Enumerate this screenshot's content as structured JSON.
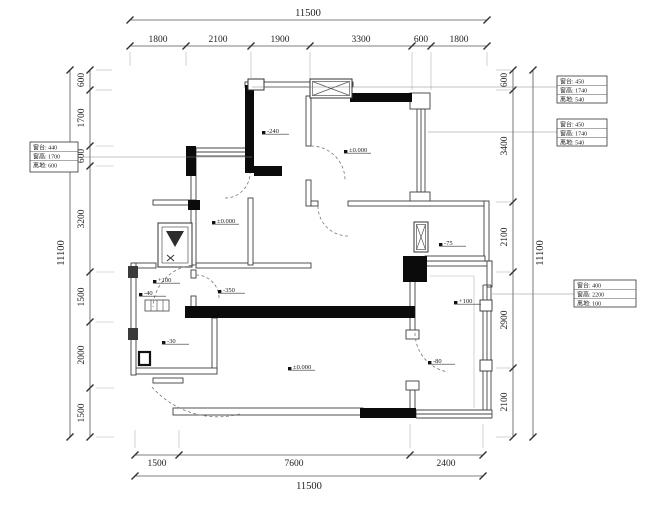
{
  "canvas": {
    "w": 648,
    "h": 505,
    "bg": "#ffffff",
    "wall_fill": "#0b0b0b",
    "thin_stroke": "#3f3f3f",
    "dim_color": "#555555",
    "text_color": "#222222",
    "leader_color": "#888888"
  },
  "dims": {
    "top_total": {
      "label": "11500",
      "x1": 130,
      "x2": 487,
      "y": 20,
      "tx": 308,
      "ty": 16
    },
    "top_segs": {
      "y": 46,
      "ticks": [
        130,
        186,
        251,
        310,
        412,
        431,
        487
      ],
      "labels": [
        {
          "t": "1800",
          "x": 158
        },
        {
          "t": "2100",
          "x": 218
        },
        {
          "t": "1900",
          "x": 280
        },
        {
          "t": "3300",
          "x": 361
        },
        {
          "t": "600",
          "x": 421
        },
        {
          "t": "1800",
          "x": 459
        }
      ],
      "ty": 42
    },
    "bottom_segs": {
      "y": 455,
      "ticks": [
        135,
        179,
        410,
        483
      ],
      "labels": [
        {
          "t": "1500",
          "x": 157
        },
        {
          "t": "7600",
          "x": 294
        },
        {
          "t": "2400",
          "x": 446
        }
      ],
      "ty": 466
    },
    "bottom_total": {
      "label": "11500",
      "x1": 135,
      "x2": 483,
      "y": 476,
      "tx": 309,
      "ty": 489
    },
    "left_segs": {
      "x": 90,
      "ticks": [
        70,
        90,
        146,
        166,
        272,
        322,
        388,
        437
      ],
      "labels": [
        {
          "t": "600",
          "y": 80
        },
        {
          "t": "1700",
          "y": 118
        },
        {
          "t": "600",
          "y": 156
        },
        {
          "t": "3200",
          "y": 219
        },
        {
          "t": "1500",
          "y": 297
        },
        {
          "t": "2000",
          "y": 355
        },
        {
          "t": "1500",
          "y": 413
        }
      ],
      "tx": 84
    },
    "left_total": {
      "label": "11100",
      "x": 70,
      "y1": 70,
      "y2": 437,
      "tx": 64,
      "ty": 253
    },
    "right_segs": {
      "x": 513,
      "ticks": [
        70,
        90,
        202,
        272,
        368,
        437
      ],
      "labels": [
        {
          "t": "600",
          "y": 80
        },
        {
          "t": "3400",
          "y": 146
        },
        {
          "t": "2100",
          "y": 237
        },
        {
          "t": "2900",
          "y": 320
        },
        {
          "t": "2100",
          "y": 402
        }
      ],
      "tx": 507
    },
    "right_total": {
      "label": "11100",
      "x": 533,
      "y1": 70,
      "y2": 437,
      "tx": 543,
      "ty": 253
    }
  },
  "markers": [
    {
      "t": "-240",
      "x": 270,
      "y": 130
    },
    {
      "t": "±0.000",
      "x": 352,
      "y": 149
    },
    {
      "t": "±0.000",
      "x": 220,
      "y": 220
    },
    {
      "t": "-350",
      "x": 226,
      "y": 289
    },
    {
      "t": "+100",
      "x": 161,
      "y": 279
    },
    {
      "t": "-40",
      "x": 147,
      "y": 292
    },
    {
      "t": "-30",
      "x": 170,
      "y": 340
    },
    {
      "t": "±0.000",
      "x": 296,
      "y": 366
    },
    {
      "t": "-75",
      "x": 447,
      "y": 242
    },
    {
      "t": "+100",
      "x": 462,
      "y": 300
    },
    {
      "t": "-80",
      "x": 436,
      "y": 360
    }
  ],
  "ann_boxes": [
    {
      "x": 30,
      "y": 142,
      "w": 48,
      "h": 30,
      "lines": [
        "窗台: 440",
        "窗高: 1700",
        "离地: 600"
      ],
      "leader": {
        "x1": 78,
        "y1": 157,
        "x2": 252,
        "y2": 157
      }
    },
    {
      "x": 557,
      "y": 76,
      "w": 50,
      "h": 27,
      "lines": [
        "窗台: 450",
        "窗高: 1740",
        "离地: 540"
      ],
      "leader": {
        "x1": 557,
        "y1": 87,
        "x2": 252,
        "y2": 87
      }
    },
    {
      "x": 557,
      "y": 119,
      "w": 50,
      "h": 27,
      "lines": [
        "窗台: 450",
        "窗高: 1740",
        "离地: 540"
      ],
      "leader": {
        "x1": 557,
        "y1": 132,
        "x2": 428,
        "y2": 132
      }
    },
    {
      "x": 574,
      "y": 280,
      "w": 62,
      "h": 27,
      "lines": [
        "窗台: 400",
        "窗高: 2200",
        "离地: 100"
      ],
      "leader": {
        "x1": 574,
        "y1": 294,
        "x2": 492,
        "y2": 294
      }
    }
  ],
  "walls_thin": [
    [
      245,
      82,
      108,
      5
    ],
    [
      311,
      93,
      41,
      5
    ],
    [
      410,
      93,
      20,
      16
    ],
    [
      410,
      192,
      20,
      14
    ],
    [
      306,
      96,
      5,
      50
    ],
    [
      306,
      180,
      5,
      26
    ],
    [
      311,
      201,
      7,
      5
    ],
    [
      348,
      201,
      137,
      5
    ],
    [
      484,
      201,
      5,
      64
    ],
    [
      191,
      157,
      5,
      108
    ],
    [
      133,
      263,
      23,
      5
    ],
    [
      196,
      263,
      115,
      5
    ],
    [
      248,
      198,
      5,
      67
    ],
    [
      153,
      200,
      43,
      5
    ],
    [
      191,
      270,
      5,
      8
    ],
    [
      191,
      296,
      5,
      15
    ],
    [
      212,
      318,
      5,
      52
    ],
    [
      133,
      368,
      84,
      6
    ],
    [
      153,
      378,
      30,
      5
    ],
    [
      131,
      263,
      5,
      112
    ],
    [
      173,
      408,
      190,
      7
    ],
    [
      416,
      261,
      76,
      5
    ],
    [
      487,
      261,
      5,
      26
    ],
    [
      425,
      256,
      60,
      5
    ],
    [
      410,
      280,
      5,
      52
    ],
    [
      410,
      390,
      5,
      20
    ],
    [
      406,
      330,
      13,
      9
    ],
    [
      406,
      381,
      13,
      9
    ]
  ],
  "walls_black": [
    [
      245,
      85,
      9,
      88
    ],
    [
      350,
      93,
      62,
      9
    ],
    [
      186,
      146,
      10,
      30
    ],
    [
      254,
      166,
      28,
      10
    ],
    [
      185,
      306,
      230,
      12
    ],
    [
      403,
      256,
      24,
      26
    ],
    [
      360,
      408,
      56,
      10
    ],
    [
      188,
      200,
      12,
      10
    ]
  ],
  "windows": [
    {
      "o": "h",
      "x1": 196,
      "x2": 248,
      "y": 148
    },
    {
      "o": "v",
      "x": 417,
      "y1": 109,
      "y2": 192
    },
    {
      "o": "v",
      "x": 483,
      "y1": 285,
      "y2": 410
    },
    {
      "o": "h",
      "x1": 416,
      "x2": 492,
      "y": 410
    }
  ],
  "hatch_boxes": [
    {
      "x": 310,
      "y": 79,
      "w": 42,
      "h": 19
    },
    {
      "x": 414,
      "y": 222,
      "w": 14,
      "h": 30
    }
  ],
  "shaft": {
    "x": 158,
    "y": 223,
    "w": 34,
    "h": 44,
    "tri": "166,231 184,231 175,247"
  },
  "window_box": {
    "x": 248,
    "y": 79,
    "w": 16,
    "h": 11
  },
  "small_box": {
    "x": 139,
    "y": 352,
    "w": 11,
    "h": 13
  },
  "steps": {
    "x": 145,
    "y": 300,
    "w": 24,
    "h": 11
  },
  "piers_dark": [
    [
      128,
      266,
      10,
      12
    ],
    [
      128,
      328,
      10,
      12
    ]
  ],
  "piers_light": [
    [
      480,
      300,
      12,
      11
    ],
    [
      480,
      360,
      12,
      11
    ]
  ],
  "arcs": [
    "M 197,265 A 44,44 0 0 0 153,307",
    "M 152,387 A 88,88 0 0 0 240,414",
    "M 415,333 A 40,40 0 0 0 448,372",
    "M 311,146 A 34,34 0 0 1 345,180",
    "M 225,198 A 25,25 0 0 0 250,173",
    "M 318,206 A 30,30 0 0 0 348,236",
    "M 196,275 A 23,23 0 0 1 219,298"
  ],
  "ext_lines": [
    [
      130,
      52,
      130,
      66
    ],
    [
      186,
      52,
      186,
      66
    ],
    [
      251,
      52,
      251,
      78
    ],
    [
      310,
      52,
      310,
      90
    ],
    [
      412,
      52,
      412,
      90
    ],
    [
      431,
      52,
      431,
      90
    ],
    [
      487,
      52,
      487,
      66
    ],
    [
      135,
      430,
      135,
      448
    ],
    [
      179,
      430,
      179,
      448
    ],
    [
      410,
      424,
      410,
      448
    ],
    [
      483,
      424,
      483,
      448
    ],
    [
      96,
      70,
      112,
      70
    ],
    [
      96,
      90,
      112,
      90
    ],
    [
      96,
      146,
      114,
      146
    ],
    [
      96,
      166,
      114,
      166
    ],
    [
      96,
      272,
      114,
      272
    ],
    [
      96,
      322,
      114,
      322
    ],
    [
      96,
      388,
      114,
      388
    ],
    [
      96,
      437,
      114,
      437
    ],
    [
      496,
      70,
      511,
      70
    ],
    [
      496,
      90,
      511,
      90
    ],
    [
      496,
      202,
      511,
      202
    ],
    [
      496,
      272,
      511,
      272
    ],
    [
      496,
      368,
      511,
      368
    ],
    [
      496,
      437,
      511,
      437
    ],
    [
      474,
      276,
      474,
      408
    ],
    [
      430,
      276,
      474,
      276
    ]
  ]
}
